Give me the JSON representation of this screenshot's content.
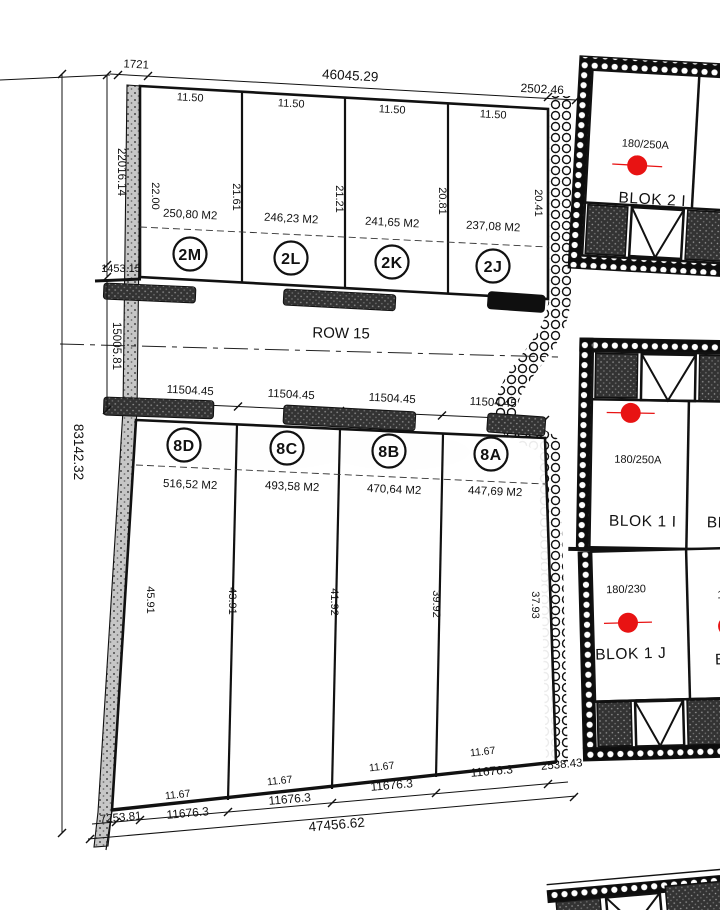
{
  "drawing": {
    "row_label": "ROW 15",
    "dims": {
      "top_offset_left": "1721",
      "top_total": "46045.29",
      "top_offset_right": "2502.46",
      "left_total": "83142.32",
      "left_upper": "22016.14",
      "left_mid": "1453.15",
      "left_lower": "15005.81",
      "bottom_offset_left": "7253.81",
      "bottom_total": "47456.62",
      "bottom_offset_right": "2538.43"
    },
    "top_plots": [
      {
        "id": "2M",
        "width": "11.50",
        "area": "250,80 M2"
      },
      {
        "id": "2L",
        "width": "11.50",
        "area": "246,23 M2"
      },
      {
        "id": "2K",
        "width": "11.50",
        "area": "241,65 M2"
      },
      {
        "id": "2J",
        "width": "11.50",
        "area": "237,08 M2"
      }
    ],
    "top_depths": [
      "22.00",
      "21.61",
      "21.21",
      "20.81",
      "20.41"
    ],
    "row_dims": [
      "11504.45",
      "11504.45",
      "11504.45",
      "11504.45"
    ],
    "bottom_plots": [
      {
        "id": "8D",
        "area": "516,52 M2",
        "width": "11.67",
        "width_mm": "11676.3"
      },
      {
        "id": "8C",
        "area": "493,58 M2",
        "width": "11.67",
        "width_mm": "11676.3"
      },
      {
        "id": "8B",
        "area": "470,64 M2",
        "width": "11.67",
        "width_mm": "11676.3"
      },
      {
        "id": "8A",
        "area": "447,69 M2",
        "width": "11.67",
        "width_mm": "11676.3"
      }
    ],
    "bottom_depths": [
      "45.91",
      "43.91",
      "41.92",
      "39.92",
      "37.93"
    ],
    "blocks": [
      {
        "name": "BLOK 2 I",
        "type": "180/250A"
      },
      {
        "name": "BLOK 1 I",
        "type": "180/250A"
      },
      {
        "name": "BLOK 1 J",
        "type": "180/230"
      }
    ],
    "partial_blocks": {
      "right_of_blok1i": "BL",
      "right_of_blok1j_name": "BLO",
      "right_of_blok1j_type": "180"
    },
    "colors": {
      "marker": "#e81313",
      "line": "#111111"
    }
  }
}
